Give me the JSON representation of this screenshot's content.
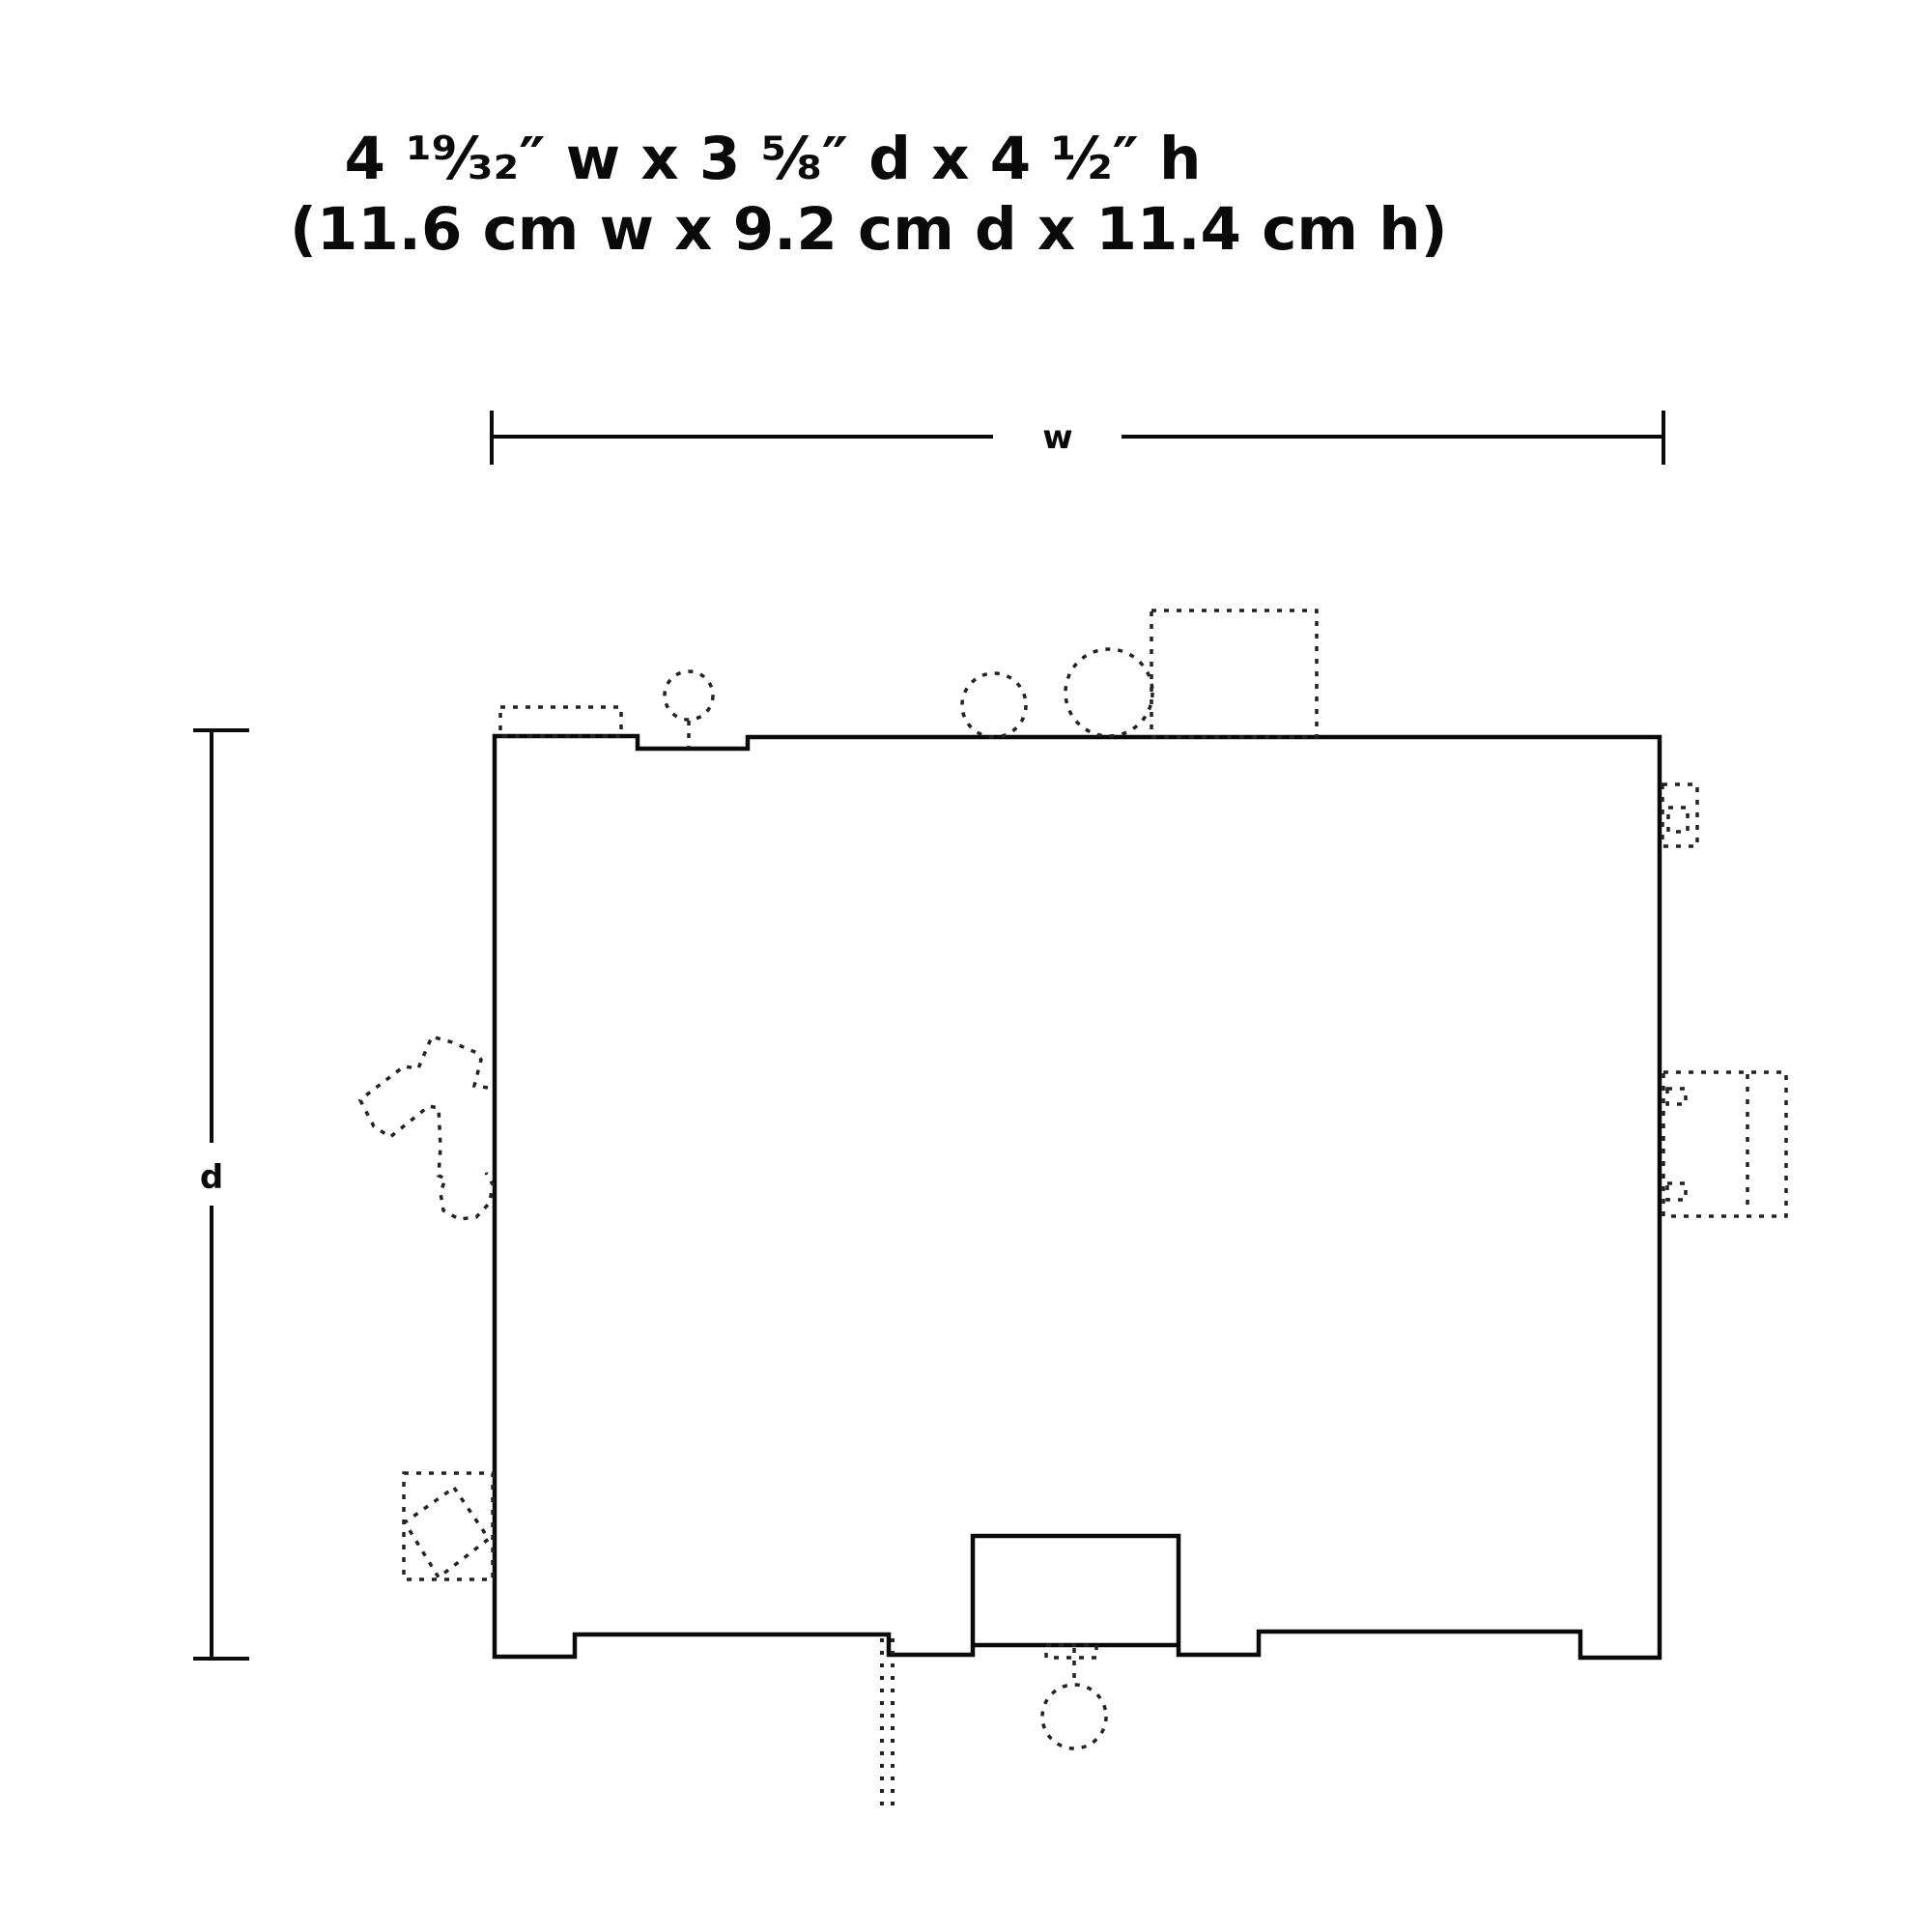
{
  "title": {
    "line1": "4 ¹⁹⁄₃₂″ w x 3 ⅝″ d x 4 ½″ h",
    "line2": "(11.6 cm w x 9.2 cm d x 11.4 cm h)"
  },
  "dimensions": {
    "width_label": "w",
    "depth_label": "d"
  },
  "colors": {
    "background": "#ffffff",
    "line": "#0a0a0a",
    "dashed_line": "#222222"
  }
}
